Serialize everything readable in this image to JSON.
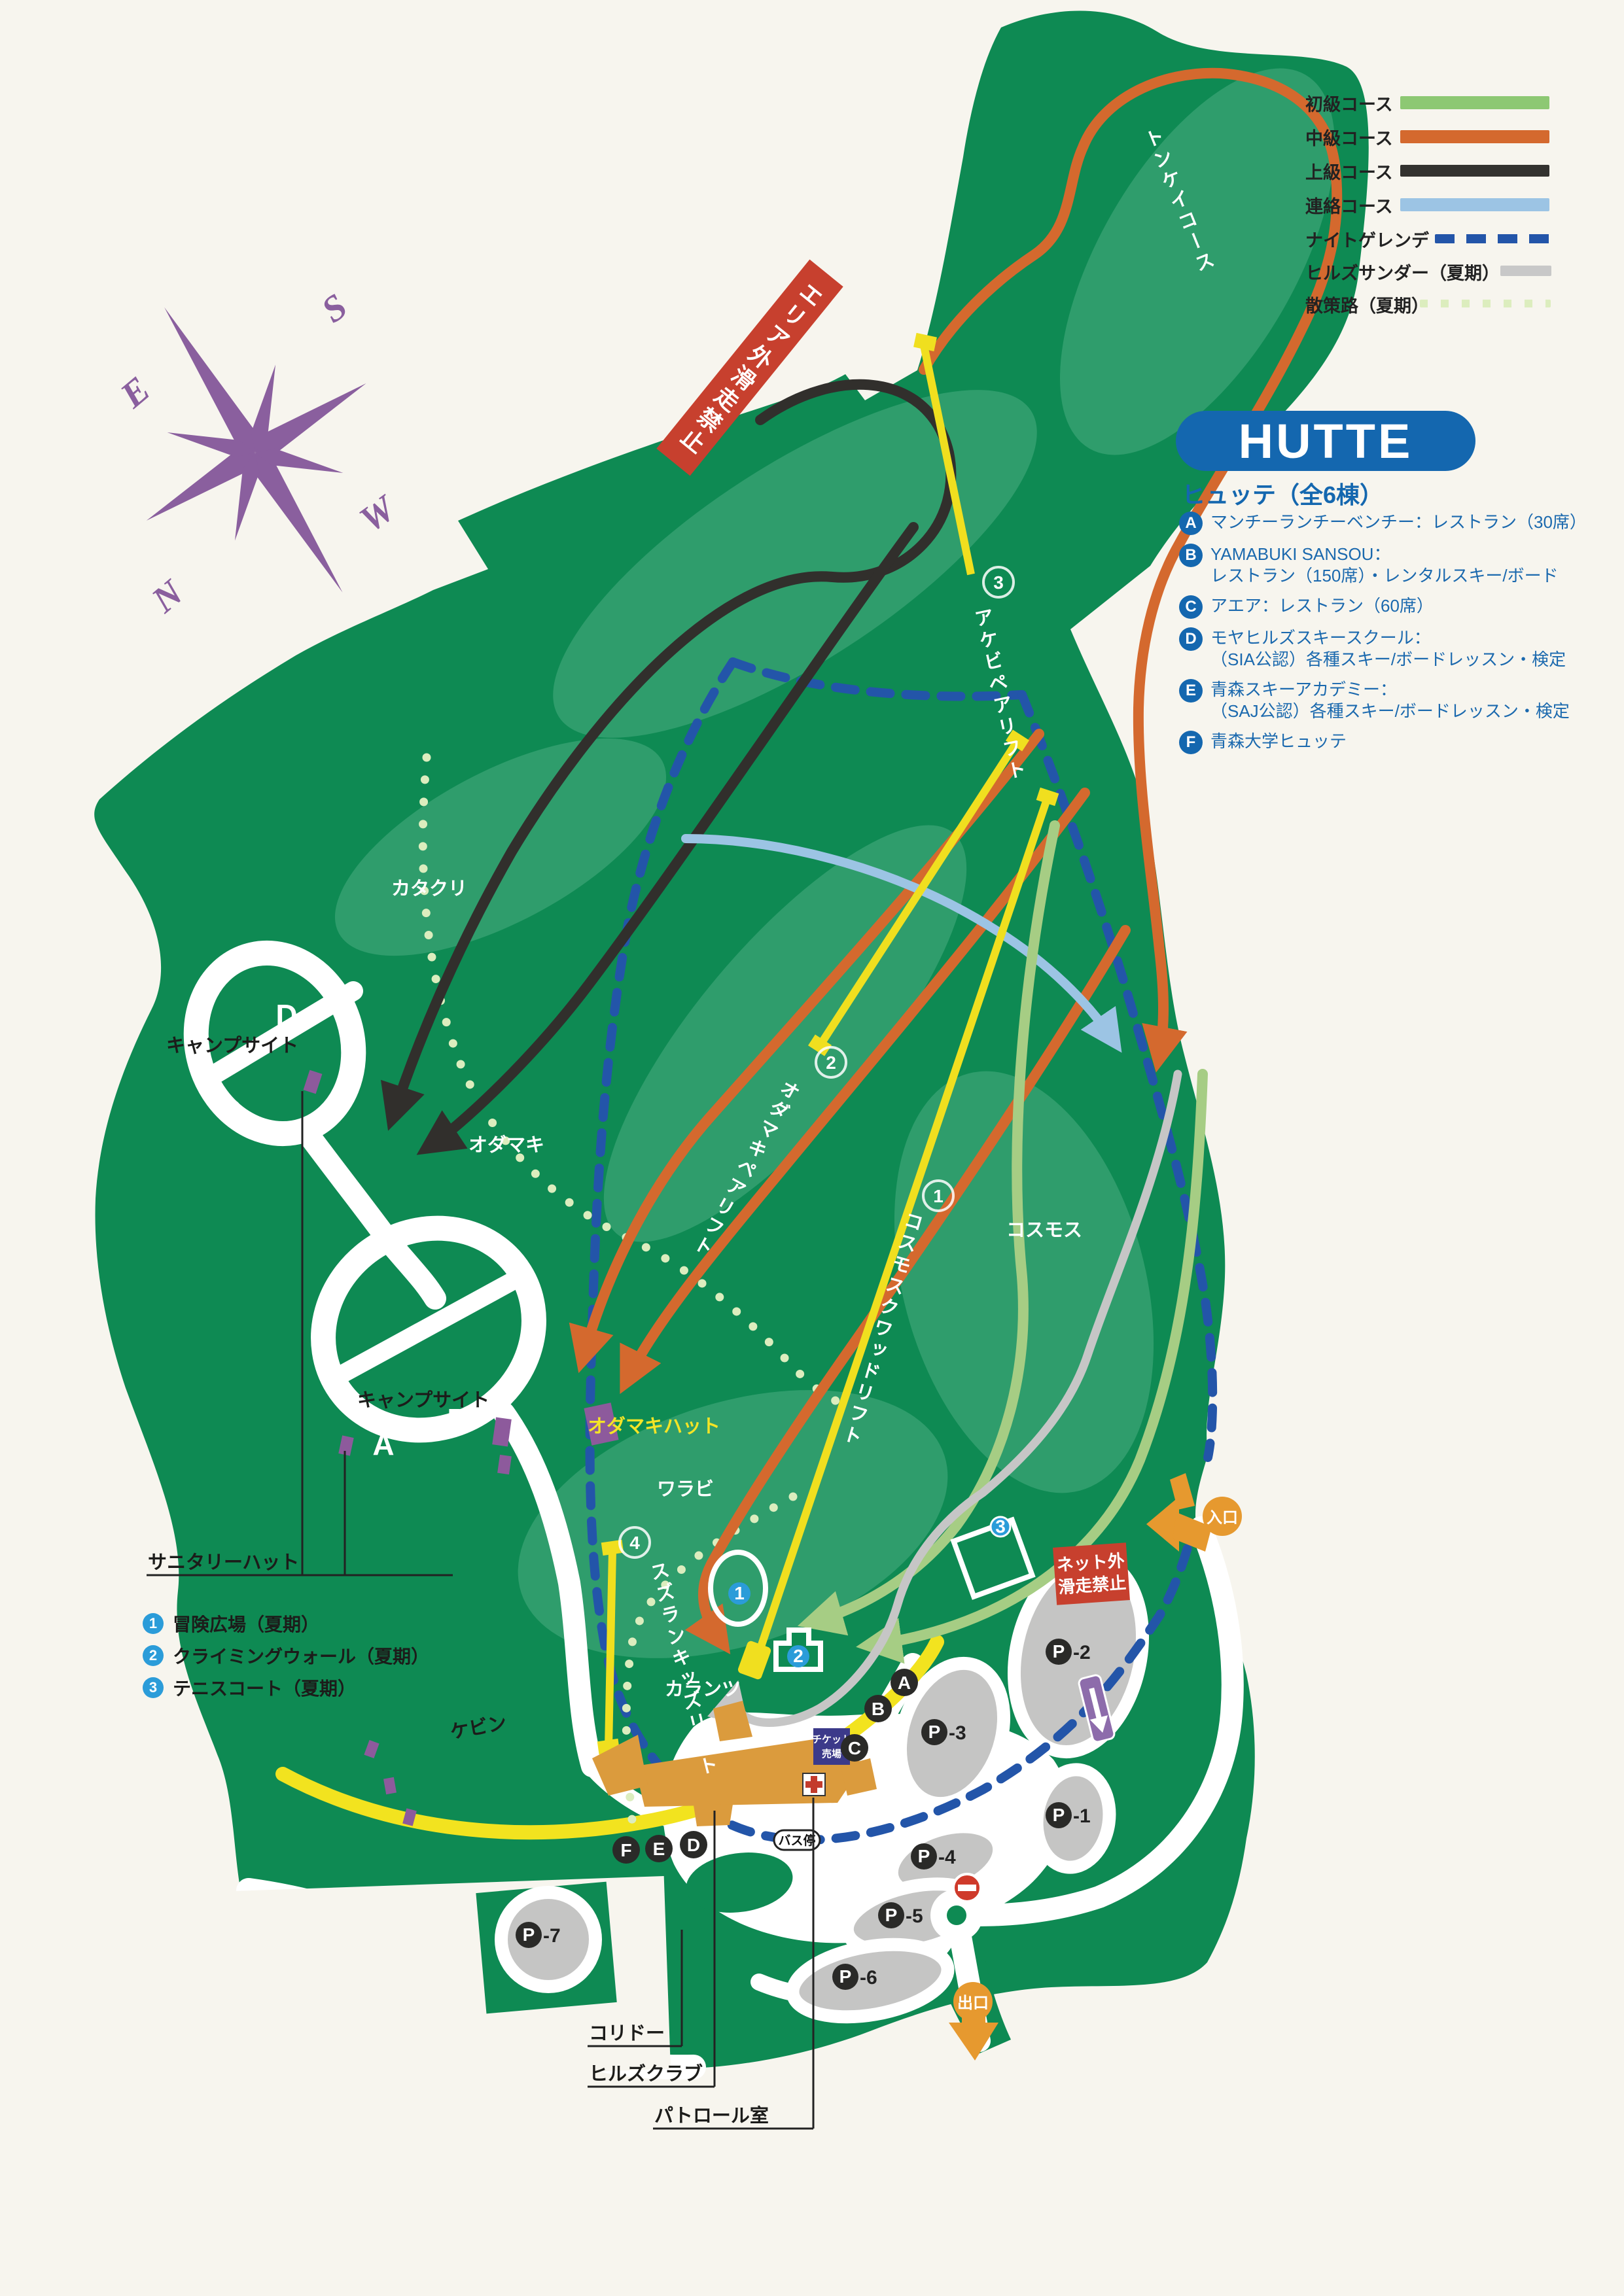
{
  "legend": {
    "items": [
      {
        "label": "初級コース",
        "color": "#8dc873",
        "style": "solid"
      },
      {
        "label": "中級コース",
        "color": "#d4692e",
        "style": "solid"
      },
      {
        "label": "上級コース",
        "color": "#33322f",
        "style": "solid"
      },
      {
        "label": "連絡コース",
        "color": "#9cc4e4",
        "style": "solid"
      },
      {
        "label": "ナイトゲレンデ",
        "color": "#2355a9",
        "style": "dashed"
      },
      {
        "label": "ヒルズサンダー（夏期）",
        "color": "#c8c8c8",
        "style": "solid"
      },
      {
        "label": "散策路（夏期）",
        "color": "#dcedbe",
        "style": "dotted"
      }
    ]
  },
  "hutte_panel": {
    "title": "HUTTE",
    "subtitle": "ヒュッテ（全6棟）",
    "items": [
      {
        "key": "A",
        "line1": "マンチーランチーベンチー：レストラン（30席）",
        "line2": ""
      },
      {
        "key": "B",
        "line1": "YAMABUKI SANSOU：",
        "line2": "レストラン（150席）・レンタルスキー/ボード"
      },
      {
        "key": "C",
        "line1": "アエア：レストラン（60席）",
        "line2": ""
      },
      {
        "key": "D",
        "line1": "モヤヒルズスキースクール：",
        "line2": "（SIA公認）各種スキー/ボードレッスン・検定"
      },
      {
        "key": "E",
        "line1": "青森スキーアカデミー：",
        "line2": "（SAJ公認）各種スキー/ボードレッスン・検定"
      },
      {
        "key": "F",
        "line1": "青森大学ヒュッテ",
        "line2": ""
      }
    ]
  },
  "summer_list": {
    "items": [
      {
        "num": "1",
        "label": "冒険広場（夏期）"
      },
      {
        "num": "2",
        "label": "クライミングウォール（夏期）"
      },
      {
        "num": "3",
        "label": "テニスコート（夏期）"
      }
    ]
  },
  "banners": {
    "off_area": "エリア外滑走禁止",
    "net_line1": "ネット外",
    "net_line2": "滑走禁止"
  },
  "compass": {
    "n": "N",
    "s": "S",
    "e": "E",
    "w": "W"
  },
  "map": {
    "course_labels": {
      "tonkei": "トンケイコース"
    },
    "lifts": {
      "akebi": {
        "num": "3",
        "name": "アケビペアリフト"
      },
      "odamaki": {
        "num": "2",
        "name": "オダマキペアリフト"
      },
      "cosmos": {
        "num": "1",
        "name": "コスモスクワッドリフト"
      },
      "suzuran": {
        "num": "4",
        "name": "スズランキッズリフト"
      }
    },
    "areas": {
      "katakuri": "カタクリ",
      "odamaki": "オダマキ",
      "warabi": "ワラビ",
      "cosmos": "コスモス",
      "karantsu": "カランツ",
      "kebin": "ケビン"
    },
    "facilities": {
      "odamaki_hut": "オダマキハット",
      "sanitary_hut": "サニタリーハット",
      "campsite_upper": "キャンプサイト",
      "campsite_lower": "キャンプサイト",
      "ticket_line1": "チケット",
      "ticket_line2": "売場",
      "bus_stop": "バス停",
      "corridor": "コリドー",
      "hills_club": "ヒルズクラブ",
      "patrol_room": "パトロール室"
    },
    "camp_letters": {
      "a": "A",
      "b": "B",
      "c": "C",
      "d": "D"
    },
    "hutte_points": {
      "a": "A",
      "b": "B",
      "c": "C",
      "d": "D",
      "e": "E",
      "f": "F"
    },
    "markers": {
      "m1": "1",
      "m2": "2",
      "m3": "3"
    },
    "parking": {
      "p": "P",
      "p1": "-1",
      "p2": "-2",
      "p3": "-3",
      "p4": "-4",
      "p5": "-5",
      "p6": "-6",
      "p7": "-7"
    },
    "gates": {
      "entrance": "入口",
      "exit": "出口"
    }
  },
  "colors": {
    "map_green": "#0e8a53",
    "slope_light": "#2f9d6c",
    "hutte_blue": "#1467af",
    "summer_blue": "#2b9cd9",
    "warning_red": "#c7402e",
    "gate_orange": "#e6992f",
    "lift_yellow": "#f0df1f",
    "compass_purple": "#8a5f9e",
    "parking_gray": "#c5c5c4"
  }
}
